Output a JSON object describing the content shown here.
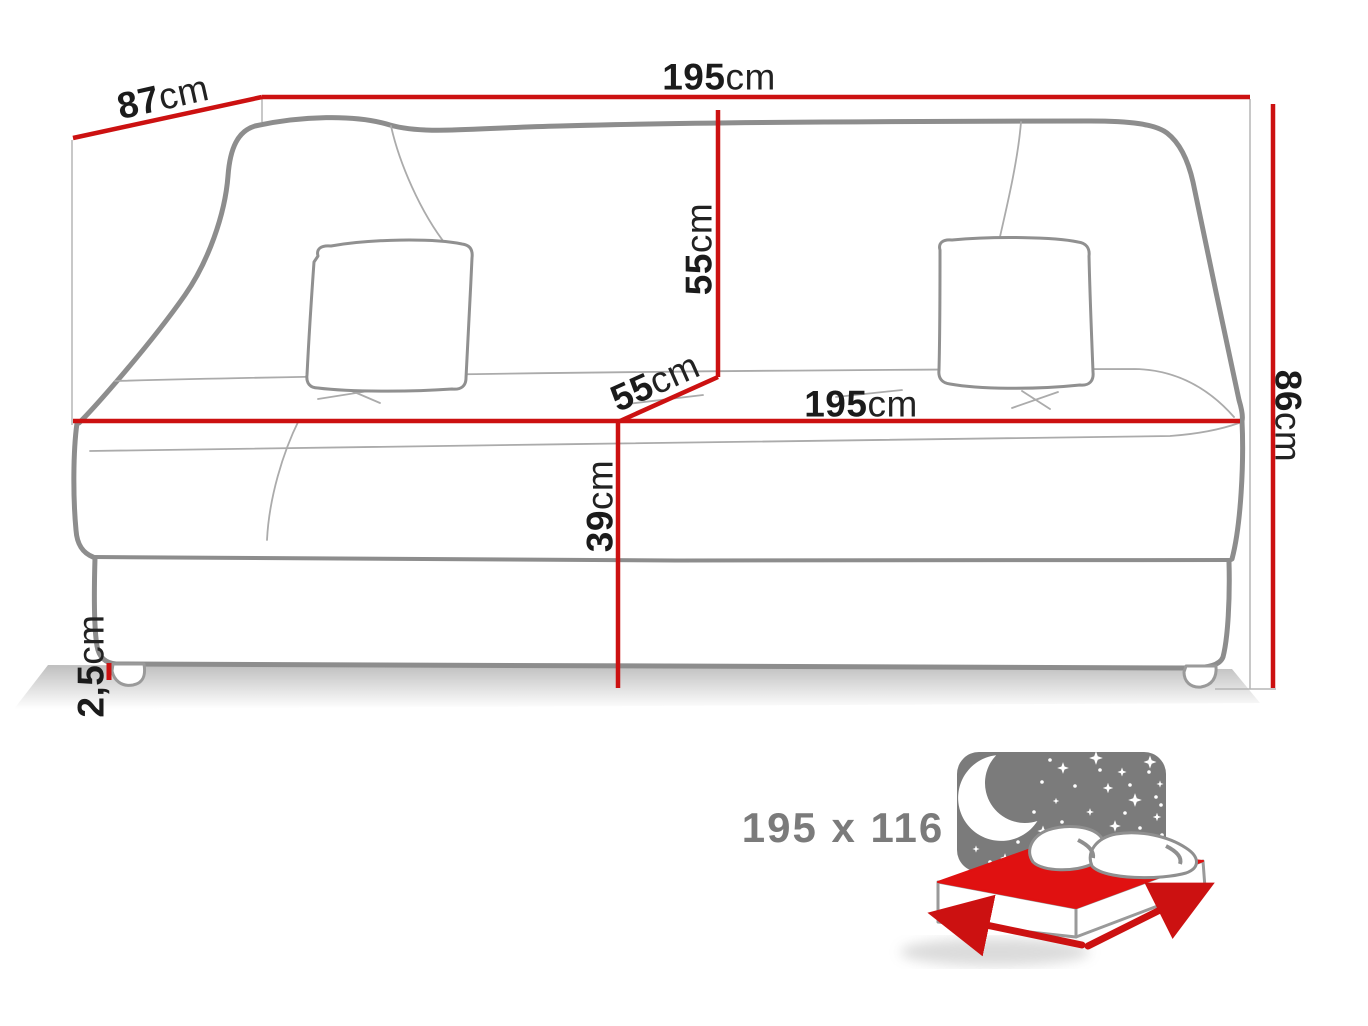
{
  "diagram": {
    "type": "sofa-bed dimension drawing",
    "colors": {
      "accent_red": "#cc1111",
      "outline_gray": "#8d8d8d",
      "thin_gray": "#ababab",
      "label_black": "#1b1b1b",
      "muted_gray": "#7b7b7b",
      "night_panel_gray": "#7b7b7b",
      "mattress_red": "#e01111"
    },
    "dimensions": {
      "depth_top": {
        "value": "87",
        "unit": "cm"
      },
      "width_top": {
        "value": "195",
        "unit": "cm"
      },
      "backrest_height": {
        "value": "55",
        "unit": "cm"
      },
      "seat_depth": {
        "value": "55",
        "unit": "cm"
      },
      "seat_width": {
        "value": "195",
        "unit": "cm"
      },
      "seat_height": {
        "value": "39",
        "unit": "cm"
      },
      "overall_height": {
        "value": "86",
        "unit": "cm"
      },
      "leg_height": {
        "value": "2,5",
        "unit": "cm"
      }
    },
    "sleeping_area": {
      "size_label": "195 x 116"
    },
    "icons": [
      {
        "name": "sleeping-area-bed-icon"
      },
      {
        "name": "moon-icon"
      },
      {
        "name": "stars-icon"
      }
    ]
  }
}
